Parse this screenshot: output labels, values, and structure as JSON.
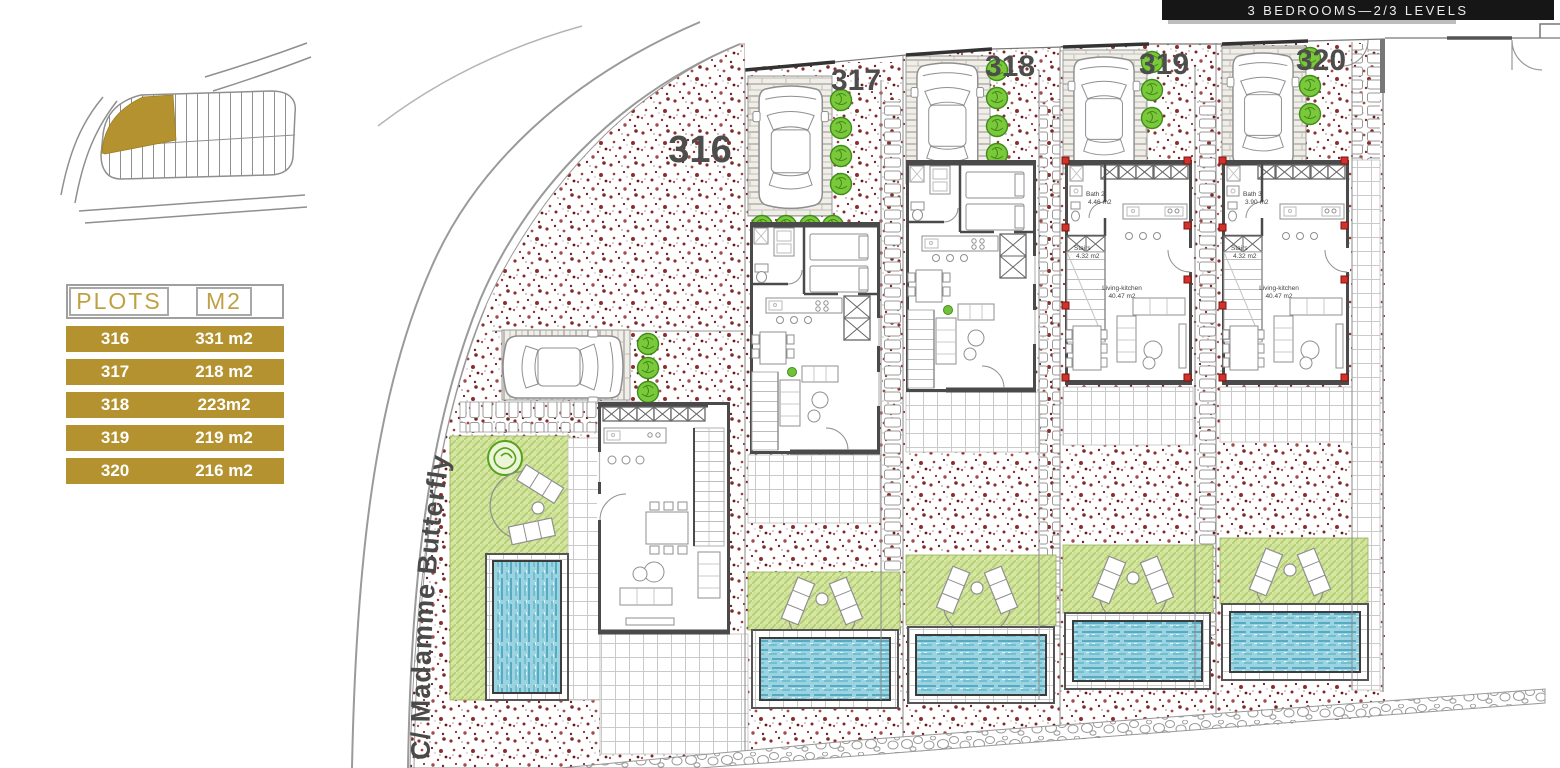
{
  "header": {
    "title": "3 BEDROOMS—2/3 LEVELS"
  },
  "legend": {
    "col_plots": "PLOTS",
    "col_m2": "M2",
    "rows": [
      {
        "plot": "316",
        "area": "331 m2"
      },
      {
        "plot": "317",
        "area": "218 m2"
      },
      {
        "plot": "318",
        "area": "223m2"
      },
      {
        "plot": "319",
        "area": "219 m2"
      },
      {
        "plot": "320",
        "area": "216 m2"
      }
    ]
  },
  "site": {
    "street": "C/ Madamme Butterfly",
    "plots": [
      {
        "number": "316"
      },
      {
        "number": "317"
      },
      {
        "number": "318"
      },
      {
        "number": "319"
      },
      {
        "number": "320"
      }
    ],
    "rooms": {
      "bath2_name": "Bath 2",
      "bath2_area": "4.46 m2",
      "bath3_name": "Bath 3",
      "bath3_area": "3.90 m2",
      "stairs_name": "Stairs",
      "stairs_area": "4.32 m2",
      "living_name": "Living-kitchen",
      "living_area": "40.47 m2"
    },
    "colors": {
      "accent_gold": "#b3922f",
      "header_gold": "#bfa144",
      "lawn_green": "#d6e6a3",
      "pool_blue": "#9bd4e0",
      "bush_green": "#7cc83b",
      "pillar_red": "#d1322b",
      "wall_gray": "#4a4a4a"
    }
  }
}
